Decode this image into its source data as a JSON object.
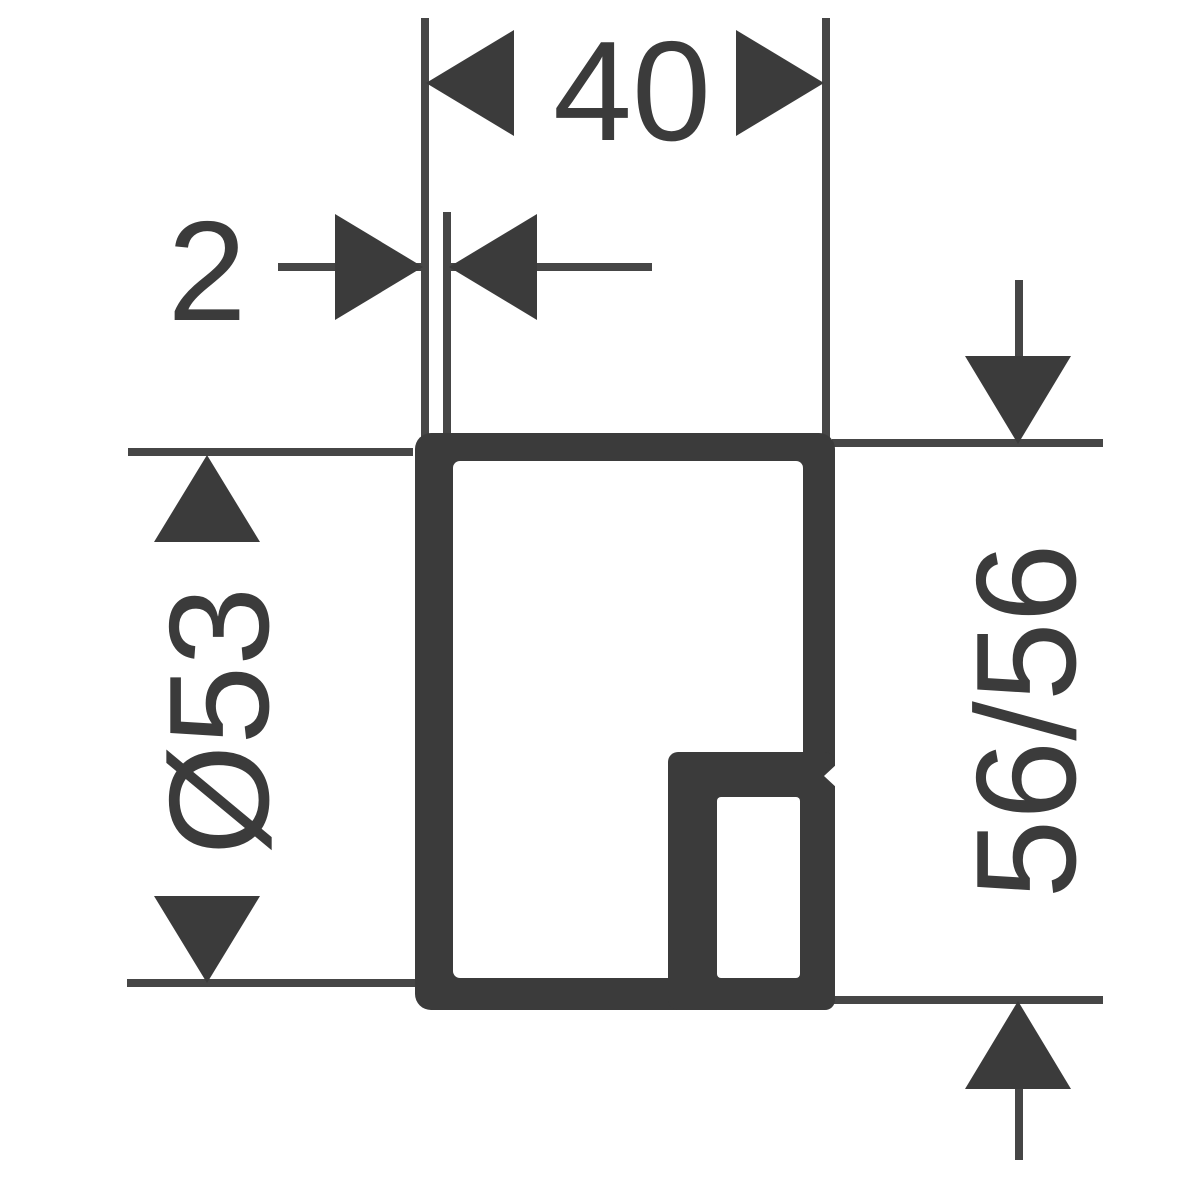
{
  "drawing": {
    "kind": "technical-dimension-diagram",
    "background_color": "#ffffff",
    "ink_color": "#3b3b3b",
    "dimensions": {
      "width": {
        "label": "40"
      },
      "wall_thickness": {
        "label": "2"
      },
      "diameter": {
        "label": "Ø53"
      },
      "height": {
        "label": "56/56"
      }
    }
  }
}
